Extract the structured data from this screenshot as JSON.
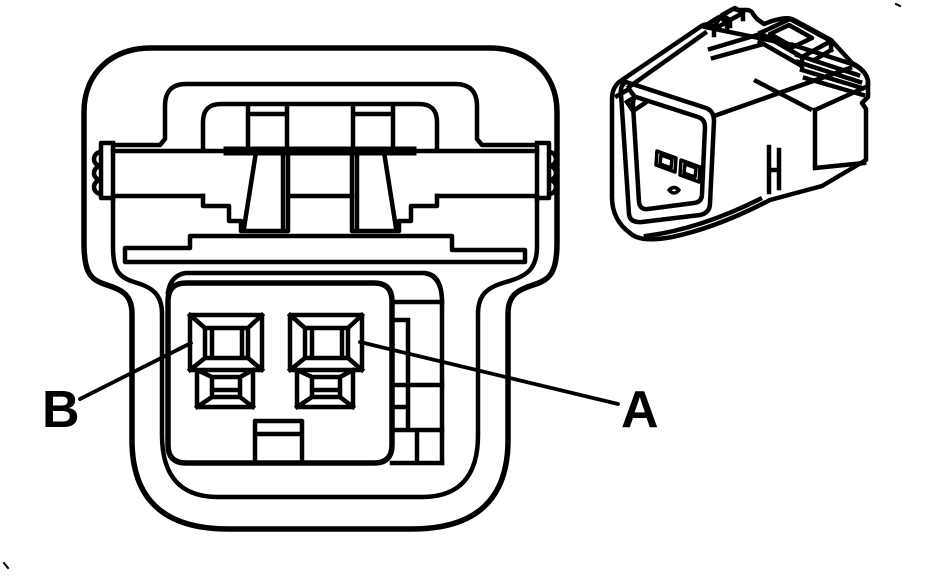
{
  "page": {
    "background_color": "#ffffff",
    "line_color": "#000000"
  },
  "figure": {
    "kind": "connector terminal identification line drawing",
    "views": {
      "front_view_name": "connector-front-face-view",
      "perspective_view_name": "connector-perspective-view"
    }
  },
  "callouts": {
    "pin_b": {
      "label": "B"
    },
    "pin_a": {
      "label": "A"
    }
  }
}
